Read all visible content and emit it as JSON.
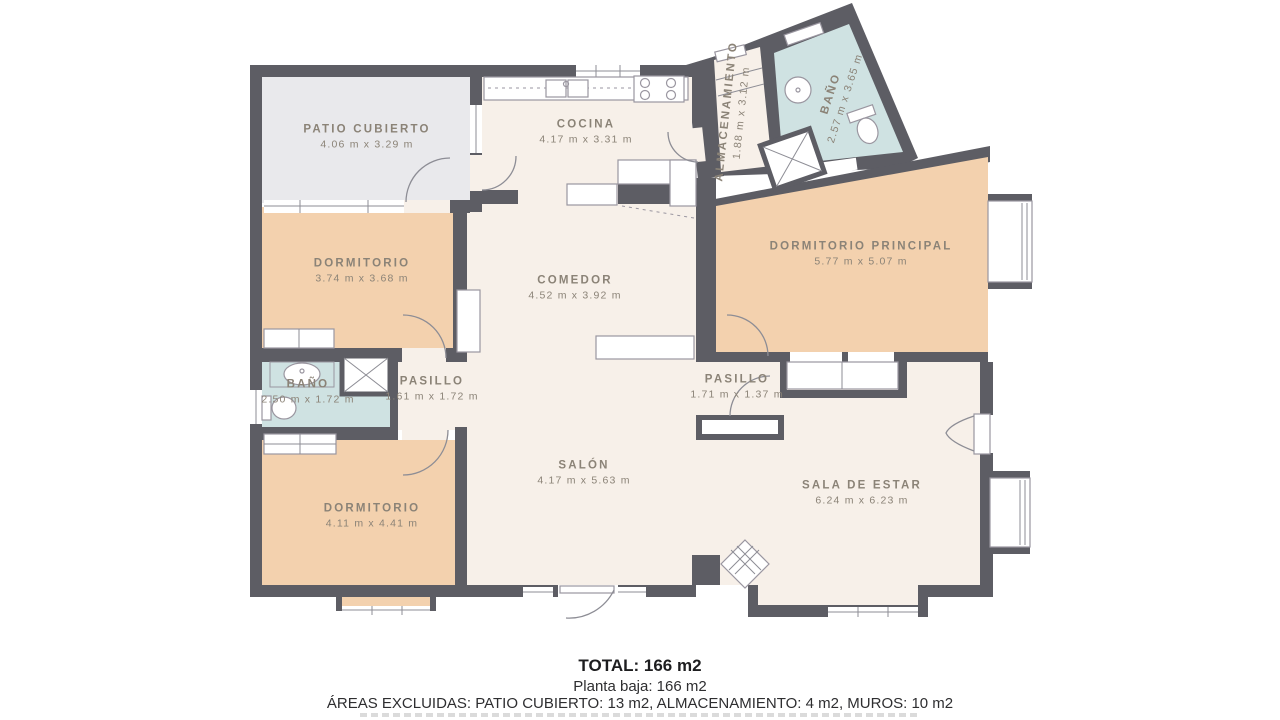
{
  "plan": {
    "rooms": [
      {
        "name": "PATIO CUBIERTO",
        "dims": "4.06 m x 3.29 m"
      },
      {
        "name": "COCINA",
        "dims": "4.17 m x 3.31 m"
      },
      {
        "name": "ALMACENAMIENTO",
        "dims": "1.88 m x 3.12 m"
      },
      {
        "name": "BAÑO",
        "dims": "2.57 m x 3.65 m"
      },
      {
        "name": "DORMITORIO",
        "dims": "3.74 m x 3.68 m"
      },
      {
        "name": "COMEDOR",
        "dims": "4.52 m x 3.92 m"
      },
      {
        "name": "DORMITORIO PRINCIPAL",
        "dims": "5.77 m x 5.07 m"
      },
      {
        "name": "BAÑO",
        "dims": "2.50 m x 1.72 m"
      },
      {
        "name": "PASILLO",
        "dims": "1.61 m x 1.72 m"
      },
      {
        "name": "PASILLO",
        "dims": "1.71 m x 1.37 m"
      },
      {
        "name": "SALÓN",
        "dims": "4.17 m x 5.63 m"
      },
      {
        "name": "DORMITORIO",
        "dims": "4.11 m x 4.41 m"
      },
      {
        "name": "SALA DE ESTAR",
        "dims": "6.24 m x 6.23 m"
      }
    ],
    "colors": {
      "wall": "#5d5d64",
      "room": "#f7f0e9",
      "bedroom": "#f3d1ae",
      "bathroom": "#cfe2e2",
      "patio": "#e9e9ec",
      "label": "#8b8377"
    }
  },
  "footer": {
    "total": "TOTAL: 166 m2",
    "floor": "Planta baja: 166 m2",
    "excluded": "ÁREAS EXCLUIDAS: PATIO CUBIERTO: 13 m2, ALMACENAMIENTO: 4 m2, MUROS: 10 m2"
  }
}
